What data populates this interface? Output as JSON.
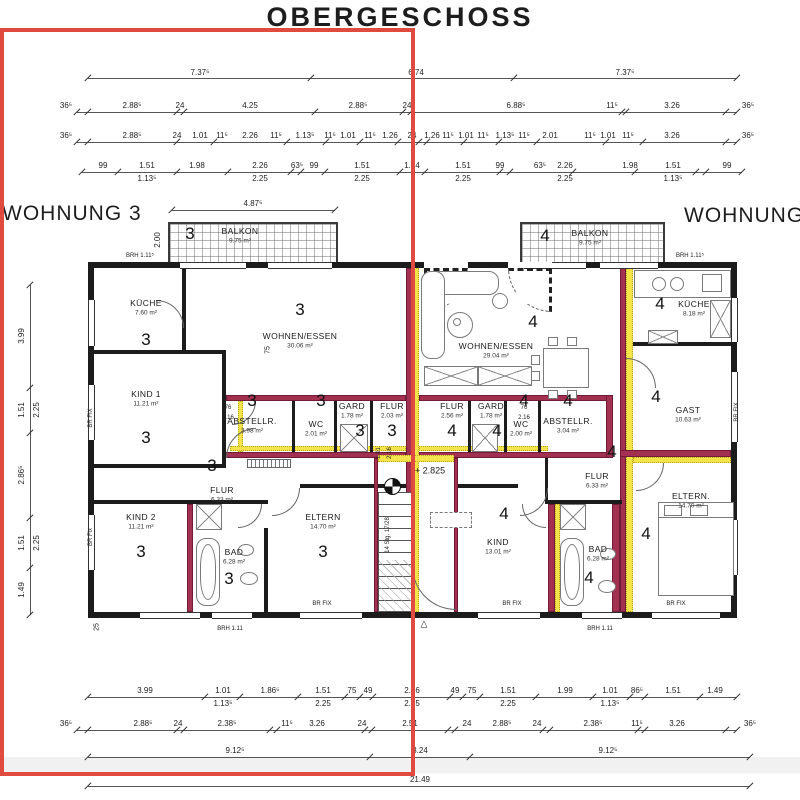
{
  "title": "OBERGESCHOSS",
  "apartments": {
    "left": "WOHNUNG 3",
    "right": "WOHNUNG 4"
  },
  "colors": {
    "overlay_red": "#df4b40",
    "wall_maroon": "#a23050",
    "insulation_yellow": "#f3e44c",
    "wall_black": "#1c1c1c"
  },
  "stairs": {
    "level_label": "+ 2.825",
    "run_label": "14 Stg. 17/28"
  },
  "rooms": [
    {
      "num": "3",
      "name": "BALKON",
      "area": "9.75 m²",
      "nx": 190,
      "ny": 234,
      "lx": 240,
      "ly": 231
    },
    {
      "num": "4",
      "name": "BALKON",
      "area": "9.75 m²",
      "nx": 545,
      "ny": 236,
      "lx": 590,
      "ly": 233
    },
    {
      "num": "3",
      "name": "KÜCHE",
      "area": "7.60 m²",
      "lx": 146,
      "ly": 303,
      "nx": 146,
      "ny": 340
    },
    {
      "num": "3",
      "name": "WOHNEN/ESSEN",
      "area": "30.06 m²",
      "lx": 300,
      "ly": 336,
      "nx": 300,
      "ny": 310
    },
    {
      "num": "3",
      "name": "KIND 1",
      "area": "11.21 m²",
      "lx": 146,
      "ly": 394,
      "nx": 146,
      "ny": 438
    },
    {
      "num": "3",
      "name": "ABSTELLR.",
      "area": "3.98 m²",
      "lx": 252,
      "ly": 421,
      "nx": 252,
      "ny": 401
    },
    {
      "num": "3",
      "name": "WC",
      "area": "2.01 m²",
      "lx": 316,
      "ly": 424,
      "nx": 321,
      "ny": 401
    },
    {
      "num": "3",
      "name": "GARD",
      "area": "1.78 m²",
      "lx": 352,
      "ly": 406,
      "nx": 360,
      "ny": 431
    },
    {
      "num": "3",
      "name": "FLUR",
      "area": "2.03 m²",
      "lx": 392,
      "ly": 406,
      "nx": 392,
      "ny": 431
    },
    {
      "num": "3",
      "name": "FLUR",
      "area": "6.33 m²",
      "lx": 222,
      "ly": 490,
      "nx": 212,
      "ny": 466
    },
    {
      "num": "3",
      "name": "KIND 2",
      "area": "11.21 m²",
      "lx": 141,
      "ly": 517,
      "nx": 141,
      "ny": 552
    },
    {
      "num": "3",
      "name": "BAD",
      "area": "6.28 m²",
      "lx": 234,
      "ly": 552,
      "nx": 229,
      "ny": 579
    },
    {
      "num": "3",
      "name": "ELTERN",
      "area": "14.70 m²",
      "lx": 323,
      "ly": 517,
      "nx": 323,
      "ny": 552
    },
    {
      "num": "4",
      "name": "WOHNEN/ESSEN",
      "area": "29.04 m²",
      "lx": 496,
      "ly": 346,
      "nx": 533,
      "ny": 322
    },
    {
      "num": "4",
      "name": "KÜCHE",
      "area": "8.18 m²",
      "lx": 694,
      "ly": 304,
      "nx": 660,
      "ny": 304
    },
    {
      "num": "4",
      "name": "GAST",
      "area": "10.63 m²",
      "lx": 688,
      "ly": 410,
      "nx": 656,
      "ny": 397
    },
    {
      "num": "4",
      "name": "FLUR",
      "area": "2.56 m²",
      "lx": 452,
      "ly": 406,
      "nx": 452,
      "ny": 431
    },
    {
      "num": "4",
      "name": "GARD",
      "area": "1.78 m²",
      "lx": 491,
      "ly": 406,
      "nx": 497,
      "ny": 431
    },
    {
      "num": "4",
      "name": "WC",
      "area": "2.00 m²",
      "lx": 521,
      "ly": 424,
      "nx": 524,
      "ny": 401
    },
    {
      "num": "4",
      "name": "ABSTELLR.",
      "area": "3.04 m²",
      "lx": 568,
      "ly": 421,
      "nx": 568,
      "ny": 401
    },
    {
      "num": "4",
      "name": "FLUR",
      "area": "6.33 m²",
      "lx": 597,
      "ly": 476,
      "nx": 612,
      "ny": 452
    },
    {
      "num": "4",
      "name": "KIND",
      "area": "13.01 m²",
      "lx": 498,
      "ly": 542,
      "nx": 504,
      "ny": 514
    },
    {
      "num": "4",
      "name": "BAD",
      "area": "6.28 m²",
      "lx": 598,
      "ly": 549,
      "nx": 589,
      "ny": 578
    },
    {
      "num": "4",
      "name": "ELTERN.",
      "area": "14.70 m²",
      "lx": 691,
      "ly": 496,
      "nx": 646,
      "ny": 534
    }
  ],
  "dim_rows": [
    {
      "y": 78,
      "x1": 88,
      "x2": 737,
      "ly": 69,
      "ticks": [
        88,
        311,
        514,
        737
      ],
      "labels": [
        {
          "x": 200,
          "t": "7.37⁵"
        },
        {
          "x": 416,
          "t": "6.74"
        },
        {
          "x": 625,
          "t": "7.37⁵"
        }
      ]
    },
    {
      "y": 112,
      "x1": 77,
      "x2": 737,
      "ly": 102,
      "ticks": [
        77,
        88,
        177,
        184,
        315,
        403,
        411,
        622,
        626,
        726,
        737
      ],
      "labels": [
        {
          "x": 66,
          "t": "36⁵"
        },
        {
          "x": 132,
          "t": "2.88⁵"
        },
        {
          "x": 180,
          "t": "24"
        },
        {
          "x": 250,
          "t": "4.25"
        },
        {
          "x": 358,
          "t": "2.88⁵"
        },
        {
          "x": 407,
          "t": "24"
        },
        {
          "x": 516,
          "t": "6.88⁵"
        },
        {
          "x": 612,
          "t": "11⁵"
        },
        {
          "x": 672,
          "t": "3.26"
        },
        {
          "x": 748,
          "t": "36⁵"
        }
      ]
    },
    {
      "y": 142,
      "x1": 77,
      "x2": 737,
      "ly": 132,
      "ticks": [
        77,
        88,
        177,
        214,
        287,
        326,
        360,
        398,
        419,
        427,
        464,
        499,
        537,
        606,
        643,
        726,
        737
      ],
      "labels": [
        {
          "x": 66,
          "t": "36⁵"
        },
        {
          "x": 132,
          "t": "2.88⁵"
        },
        {
          "x": 177,
          "t": "24"
        },
        {
          "x": 200,
          "t": "1.01"
        },
        {
          "x": 222,
          "t": "11⁵"
        },
        {
          "x": 250,
          "t": "2.26"
        },
        {
          "x": 276,
          "t": "11⁵"
        },
        {
          "x": 305,
          "t": "1.13⁵"
        },
        {
          "x": 330,
          "t": "11⁵"
        },
        {
          "x": 348,
          "t": "1.01"
        },
        {
          "x": 370,
          "t": "11⁵"
        },
        {
          "x": 390,
          "t": "1.26"
        },
        {
          "x": 412,
          "t": "24"
        },
        {
          "x": 432,
          "t": "1.26"
        },
        {
          "x": 448,
          "t": "11⁵"
        },
        {
          "x": 466,
          "t": "1.01"
        },
        {
          "x": 483,
          "t": "11⁵"
        },
        {
          "x": 505,
          "t": "1.13⁵"
        },
        {
          "x": 524,
          "t": "11⁵"
        },
        {
          "x": 550,
          "t": "2.01"
        },
        {
          "x": 590,
          "t": "11⁵"
        },
        {
          "x": 608,
          "t": "1.01"
        },
        {
          "x": 628,
          "t": "11⁵"
        },
        {
          "x": 672,
          "t": "3.26"
        },
        {
          "x": 748,
          "t": "36⁵"
        }
      ]
    },
    {
      "y": 172,
      "x1": 82,
      "x2": 742,
      "ly": 162,
      "ticks": [
        82,
        118,
        177,
        228,
        291,
        301,
        325,
        400,
        425,
        500,
        510,
        573,
        635,
        696,
        706,
        742
      ],
      "labels": [
        {
          "x": 103,
          "t": "99"
        },
        {
          "x": 147,
          "t": "1.51",
          "b": "1.13⁵"
        },
        {
          "x": 197,
          "t": "1.98"
        },
        {
          "x": 260,
          "t": "2.26",
          "b": "2.25"
        },
        {
          "x": 297,
          "t": "63⁵"
        },
        {
          "x": 314,
          "t": "99"
        },
        {
          "x": 362,
          "t": "1.51",
          "b": "2.25"
        },
        {
          "x": 412,
          "t": "1.74"
        },
        {
          "x": 463,
          "t": "1.51",
          "b": "2.25"
        },
        {
          "x": 500,
          "t": "99"
        },
        {
          "x": 540,
          "t": "63⁵"
        },
        {
          "x": 565,
          "t": "2.26",
          "b": "2.25"
        },
        {
          "x": 630,
          "t": "1.98"
        },
        {
          "x": 673,
          "t": "1.51",
          "b": "1.13⁵"
        },
        {
          "x": 727,
          "t": "99"
        }
      ]
    },
    {
      "y": 210,
      "x1": 172,
      "x2": 335,
      "ly": 200,
      "ticks": [
        172,
        335
      ],
      "labels": [
        {
          "x": 253,
          "t": "4.87⁵"
        }
      ]
    },
    {
      "y": 697,
      "x1": 88,
      "x2": 737,
      "ly": 687,
      "ticks": [
        88,
        205,
        240,
        298,
        345,
        360,
        373,
        450,
        463,
        480,
        536,
        593,
        630,
        645,
        700,
        737
      ],
      "labels": [
        {
          "x": 145,
          "t": "3.99"
        },
        {
          "x": 223,
          "t": "1.01",
          "b": "1.13⁵"
        },
        {
          "x": 270,
          "t": "1.86⁵"
        },
        {
          "x": 323,
          "t": "1.51",
          "b": "2.25"
        },
        {
          "x": 352,
          "t": "75"
        },
        {
          "x": 368,
          "t": "49"
        },
        {
          "x": 412,
          "t": "2.26",
          "b": "2.25"
        },
        {
          "x": 455,
          "t": "49"
        },
        {
          "x": 472,
          "t": "75"
        },
        {
          "x": 508,
          "t": "1.51",
          "b": "2.25"
        },
        {
          "x": 565,
          "t": "1.99"
        },
        {
          "x": 610,
          "t": "1.01",
          "b": "1.13⁵"
        },
        {
          "x": 637,
          "t": "86⁵"
        },
        {
          "x": 673,
          "t": "1.51"
        },
        {
          "x": 715,
          "t": "1.49"
        }
      ]
    },
    {
      "y": 730,
      "x1": 77,
      "x2": 737,
      "ly": 720,
      "ticks": [
        77,
        88,
        177,
        184,
        270,
        277,
        365,
        372,
        448,
        455,
        543,
        550,
        638,
        645,
        726,
        737
      ],
      "labels": [
        {
          "x": 66,
          "t": "36⁵"
        },
        {
          "x": 143,
          "t": "2.88⁵"
        },
        {
          "x": 178,
          "t": "24"
        },
        {
          "x": 227,
          "t": "2.38⁵"
        },
        {
          "x": 287,
          "t": "11⁵"
        },
        {
          "x": 317,
          "t": "3.26"
        },
        {
          "x": 362,
          "t": "24"
        },
        {
          "x": 410,
          "t": "2.51"
        },
        {
          "x": 467,
          "t": "24"
        },
        {
          "x": 502,
          "t": "2.88⁵"
        },
        {
          "x": 537,
          "t": "24"
        },
        {
          "x": 593,
          "t": "2.38⁵"
        },
        {
          "x": 637,
          "t": "11⁵"
        },
        {
          "x": 677,
          "t": "3.26"
        },
        {
          "x": 750,
          "t": "36⁵"
        }
      ]
    },
    {
      "y": 757,
      "x1": 88,
      "x2": 750,
      "ly": 747,
      "ticks": [
        88,
        370,
        470,
        750
      ],
      "labels": [
        {
          "x": 235,
          "t": "9.12⁵"
        },
        {
          "x": 420,
          "t": "3.24"
        },
        {
          "x": 608,
          "t": "9.12⁵"
        }
      ]
    },
    {
      "y": 786,
      "x1": 88,
      "x2": 750,
      "ly": 776,
      "ticks": [
        88,
        750
      ],
      "labels": [
        {
          "x": 420,
          "t": "21.49"
        }
      ]
    }
  ],
  "vdim": {
    "x": 30,
    "y1": 285,
    "y2": 615,
    "ticks": [
      285,
      388,
      433,
      518,
      568,
      615
    ],
    "labels": [
      {
        "y": 336,
        "t": "3.99"
      },
      {
        "y": 410,
        "t": "1.51",
        "b": "2.25"
      },
      {
        "y": 475,
        "t": "2.86⁵"
      },
      {
        "y": 543,
        "t": "1.51",
        "b": "2.25"
      },
      {
        "y": 590,
        "t": "1.49"
      }
    ]
  },
  "annotations": [
    {
      "x": 158,
      "y": 240,
      "t": "2.00",
      "rot": 1,
      "fs": 8
    },
    {
      "x": 140,
      "y": 256,
      "t": "BRH 1.11⁵",
      "fs": 6
    },
    {
      "x": 690,
      "y": 256,
      "t": "BRH 1.11⁵",
      "fs": 6
    },
    {
      "x": 230,
      "y": 629,
      "t": "BRH 1.11",
      "fs": 6
    },
    {
      "x": 600,
      "y": 629,
      "t": "BRH 1.11",
      "fs": 6
    },
    {
      "x": 322,
      "y": 604,
      "t": "BR FIX",
      "fs": 6
    },
    {
      "x": 512,
      "y": 604,
      "t": "BR FIX",
      "fs": 6
    },
    {
      "x": 676,
      "y": 604,
      "t": "BR FIX",
      "fs": 6
    },
    {
      "x": 91,
      "y": 418,
      "t": "BR FIX",
      "rot": 1,
      "fs": 6
    },
    {
      "x": 91,
      "y": 537,
      "t": "BR Fix",
      "rot": 1,
      "fs": 6
    },
    {
      "x": 737,
      "y": 412,
      "t": "BR FIX",
      "rot": 1,
      "fs": 6
    },
    {
      "x": 430,
      "y": 471,
      "t": "+ 2.825",
      "fs": 9
    },
    {
      "x": 388,
      "y": 535,
      "t": "14 Stg. 17/28",
      "rot": 1,
      "fs": 6
    },
    {
      "x": 228,
      "y": 408,
      "t": "76",
      "fs": 6
    },
    {
      "x": 228,
      "y": 418,
      "t": "2.16",
      "fs": 6
    },
    {
      "x": 524,
      "y": 408,
      "t": "76",
      "fs": 6
    },
    {
      "x": 524,
      "y": 418,
      "t": "2.16",
      "fs": 6
    },
    {
      "x": 268,
      "y": 350,
      "t": "75",
      "rot": 1,
      "fs": 7
    },
    {
      "x": 97,
      "y": 627,
      "t": "25",
      "rot": 1,
      "fs": 7
    },
    {
      "x": 379,
      "y": 453,
      "t": "1.01",
      "rot": 1,
      "fs": 6
    },
    {
      "x": 390,
      "y": 453,
      "t": "2.16",
      "rot": 1,
      "fs": 6
    },
    {
      "x": 424,
      "y": 624,
      "t": "△",
      "fs": 9
    }
  ]
}
